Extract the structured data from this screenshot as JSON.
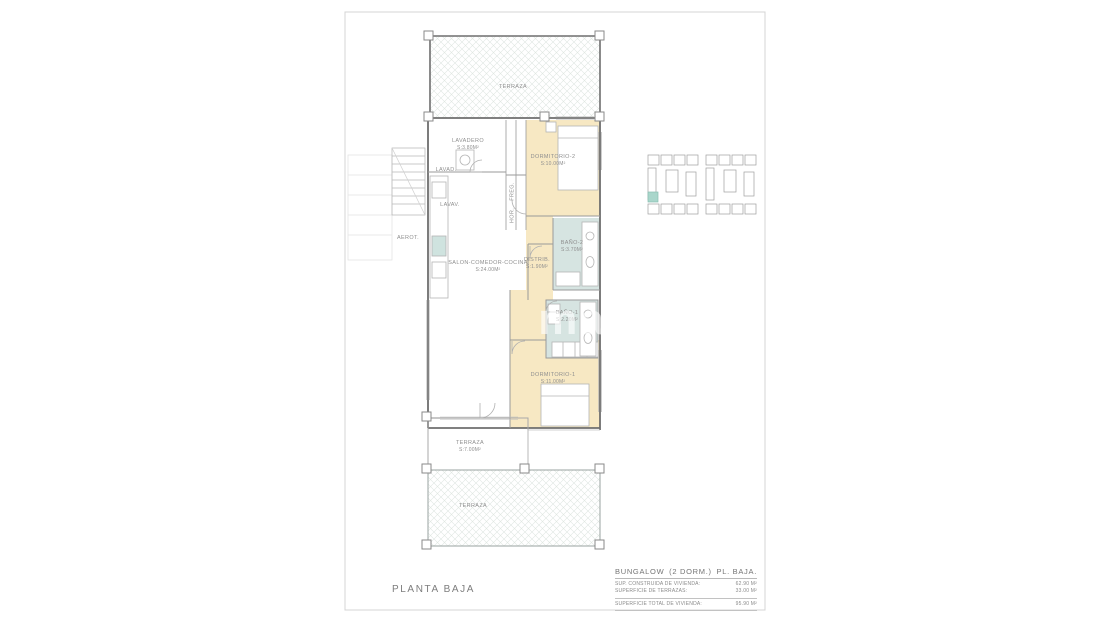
{
  "colors": {
    "bedroom_fill": "#f7e8c3",
    "bath_fill": "#d6e4e1",
    "wall_line": "#8a8a8a",
    "hatch_line": "#dde4e0",
    "keyplan_highlight": "#a9d6cb",
    "label_text": "#8f8f8f"
  },
  "plan": {
    "title": "PLANTA BAJA",
    "watermark": "ma",
    "rooms": {
      "terraza_top": {
        "name": "TERRAZA"
      },
      "lavadero": {
        "name": "LAVADERO",
        "area": "S:3.80M²"
      },
      "dormitorio2": {
        "name": "DORMITORIO-2",
        "area": "S:10.00M²"
      },
      "bano2": {
        "name": "BAÑO-2",
        "area": "S:3.70M²"
      },
      "distrib": {
        "name": "DISTRIB.",
        "area": "S:1.90M²"
      },
      "bano1": {
        "name": "BAÑO-1",
        "area": "S:2.20M²"
      },
      "dormitorio1": {
        "name": "DORMITORIO-1",
        "area": "S:11.00M²"
      },
      "salon": {
        "name": "SALON-COMEDOR-COCINA",
        "area": "S:24.00M²"
      },
      "terraza_mid": {
        "name": "TERRAZA",
        "area": "S:7.00M²"
      },
      "terraza_bottom": {
        "name": "TERRAZA"
      }
    },
    "fixtures": {
      "lavad": "LAVAD.",
      "lavav": "LAVAV.",
      "aerot": "AEROT.",
      "freg": "FREG.",
      "hor": "HOR."
    }
  },
  "title_block": {
    "type_label": "BUNGALOW",
    "dorm_label": "(2 DORM.)",
    "floor_label": "PL. BAJA.",
    "rows": [
      {
        "label": "SUP. CONSTRUIDA DE VIVIENDA:",
        "value": "62.90 M²"
      },
      {
        "label": "SUPERFICIE DE TERRAZAS:",
        "value": "33.00 M²"
      },
      {
        "label": "SUPERFICIE TOTAL DE VIVIENDA:",
        "value": "95.90 M²"
      }
    ]
  }
}
